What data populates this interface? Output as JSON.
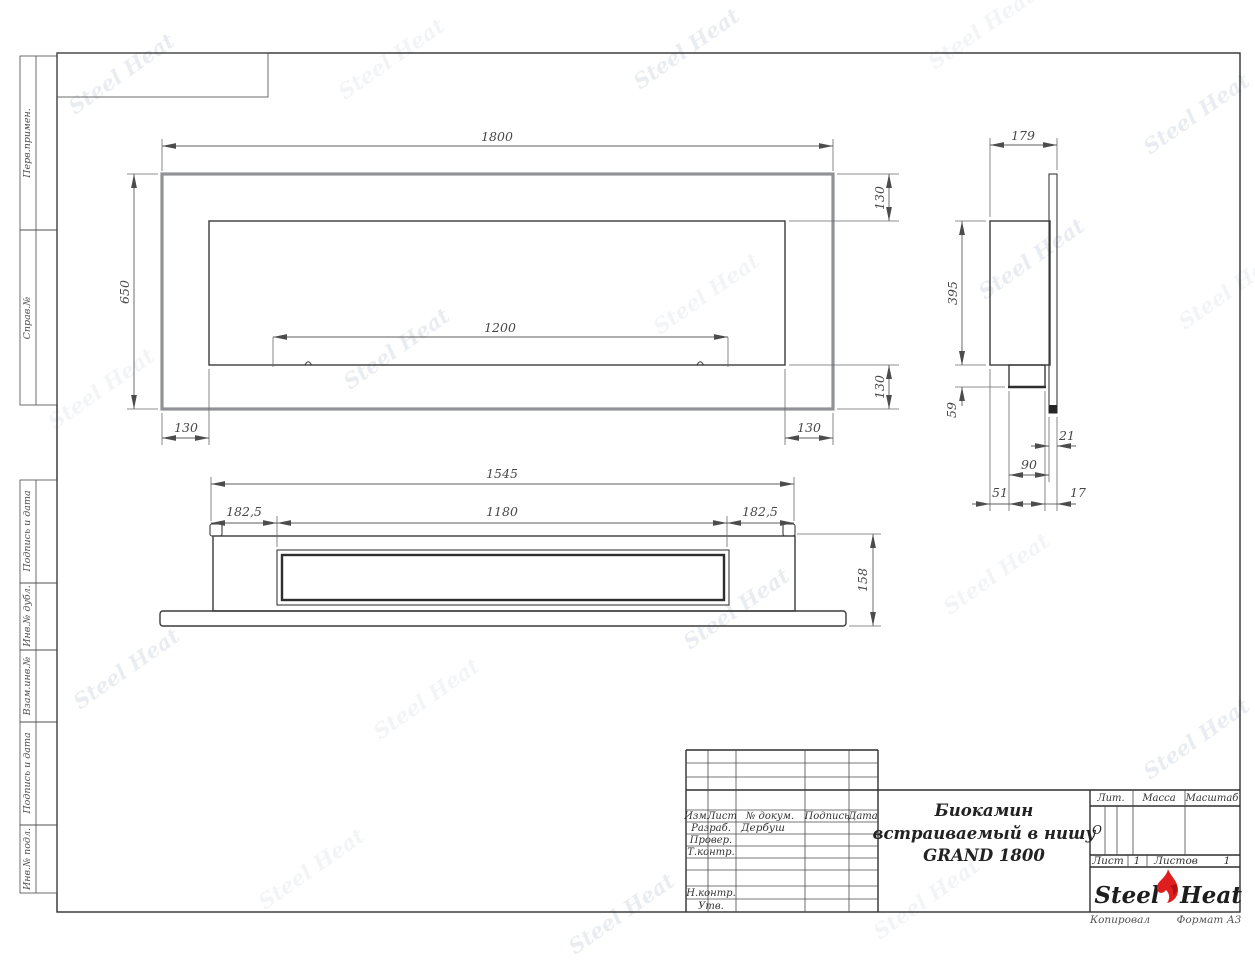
{
  "watermark": {
    "text": "Steel Heat"
  },
  "sidebar": {
    "labels": [
      "Перв.примен.",
      "Справ.№",
      "Подпись и дата",
      "Инв.№ дубл.",
      "Взам.инв.№",
      "Подпись и дата",
      "Инв.№ подл."
    ]
  },
  "views": {
    "front": {
      "width": "1800",
      "height": "650",
      "burner_span": "1200",
      "top_offset": "130",
      "bottom_offset": "130",
      "left_offset": "130",
      "right_offset": "130"
    },
    "side": {
      "depth": "179",
      "niche_height": "395",
      "burner_box_height": "59",
      "panel_width": "21",
      "burner_box_depth": "90",
      "back_offset": "51",
      "gap": "17"
    },
    "bottom": {
      "body_width": "1545",
      "left_margin": "182,5",
      "burner_width": "1180",
      "right_margin": "182,5",
      "depth": "158"
    }
  },
  "title_block": {
    "header_cols": [
      "Изм.",
      "Лист",
      "№ докум.",
      "Подпись",
      "Дата"
    ],
    "rows": {
      "developed_label": "Разраб.",
      "developed_value": "Дербуш",
      "checked_label": "Провер.",
      "tcontrol_label": "Т.контр.",
      "ncontrol_label": "Н.контр.",
      "approved_label": "Утв."
    },
    "title_line1": "Биокамин",
    "title_line2": "встраиваемый в нишу",
    "title_line3": "GRAND 1800",
    "lit_label": "Лит.",
    "lit_value": "О",
    "mass_label": "Масса",
    "scale_label": "Масштаб",
    "sheet_label": "Лист",
    "sheet_number": "1",
    "sheets_label": "Листов",
    "sheets_total": "1",
    "logo_left": "Steel",
    "logo_right": "Heat"
  },
  "footer": {
    "copied": "Копировал",
    "format": "Формат А3"
  }
}
